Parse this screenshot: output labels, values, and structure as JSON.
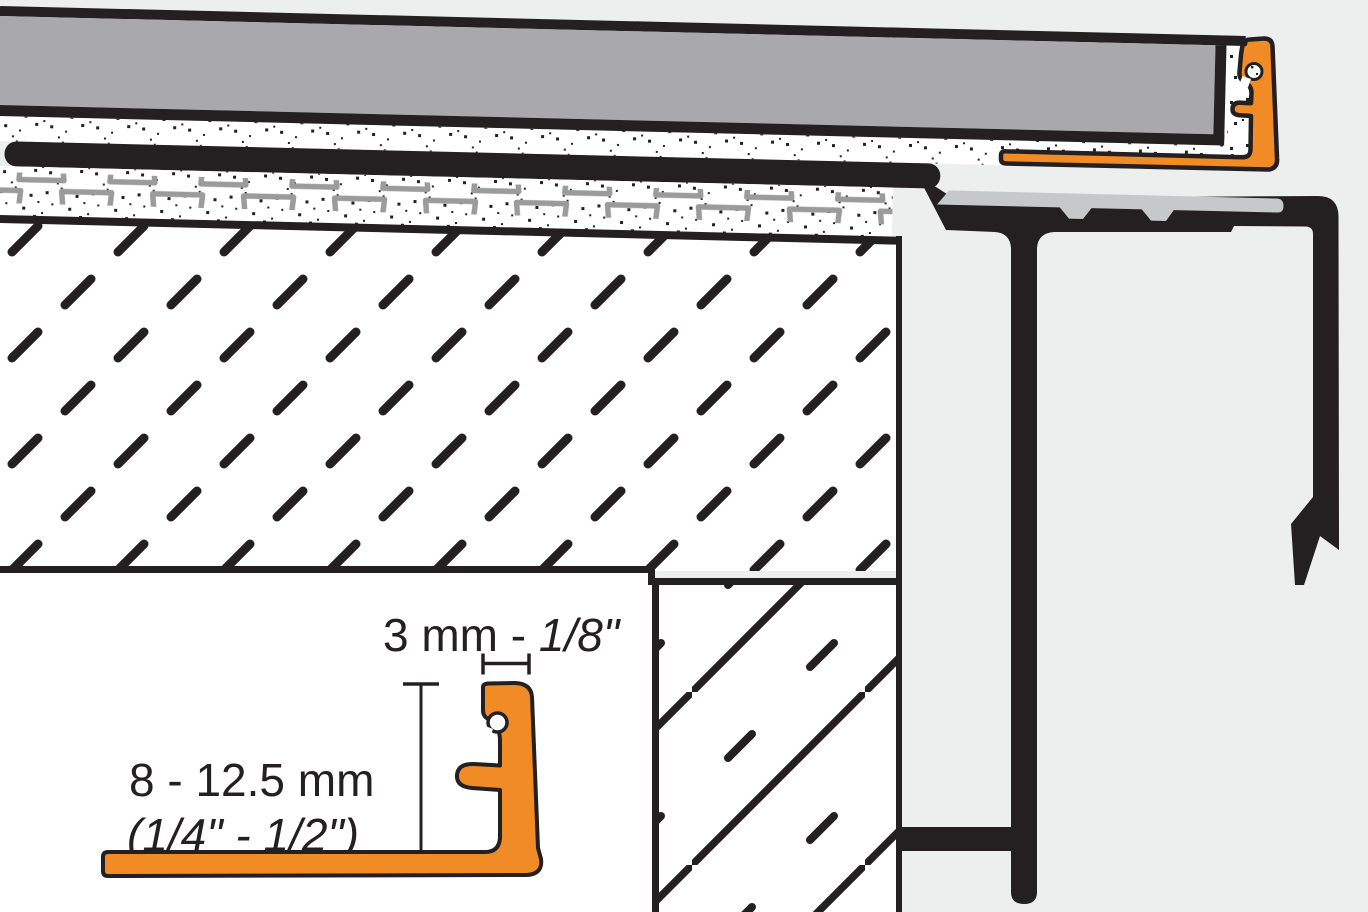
{
  "diagram": {
    "inset": {
      "width_dim": {
        "prefix": "3 mm - ",
        "value": "1/8\""
      },
      "height_dim": {
        "line1": "8 - 12.5 mm",
        "line2": "(1/4\" - 1/2\")"
      }
    },
    "colors": {
      "background": "#EDEEEE",
      "tile_gray": "#A9A9AB",
      "support_gray": "#C7C8C9",
      "membrane_gray": "#9B9B9B",
      "accent_orange": "#F18B25",
      "line_black": "#242021"
    }
  }
}
